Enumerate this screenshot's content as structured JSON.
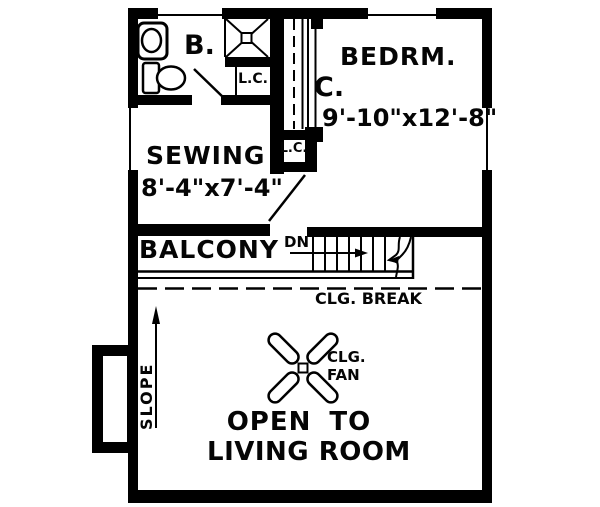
{
  "rooms": {
    "bathroom": {
      "label": "B."
    },
    "bedroom": {
      "label": "BEDRM.",
      "dimensions": "9'-10\"x12'-8\""
    },
    "closet": {
      "label": "C."
    },
    "linen_closet_upper": {
      "label": "L.C."
    },
    "linen_closet_lower": {
      "label": "L.C."
    },
    "sewing": {
      "label": "SEWING",
      "dimensions": "8'-4\"x7'-4\""
    },
    "balcony": {
      "label": "BALCONY"
    },
    "open_to_living": {
      "line1": "OPEN TO",
      "line2": "LIVING ROOM"
    }
  },
  "annotations": {
    "stair_direction": "DN",
    "ceiling_break": "CLG. BREAK",
    "ceiling_fan": {
      "line1": "CLG.",
      "line2": "FAN"
    },
    "slope": "SLOPE"
  },
  "icons": [
    {
      "name": "sink-icon"
    },
    {
      "name": "toilet-icon"
    },
    {
      "name": "shower-icon"
    },
    {
      "name": "ceiling-fan-icon"
    },
    {
      "name": "stairs-icon"
    },
    {
      "name": "stair-break-icon"
    },
    {
      "name": "down-arrow-icon"
    },
    {
      "name": "slope-arrow-icon"
    },
    {
      "name": "door-swing-icon"
    },
    {
      "name": "window-icon"
    }
  ],
  "colors": {
    "line": "#000000",
    "background": "#ffffff"
  }
}
